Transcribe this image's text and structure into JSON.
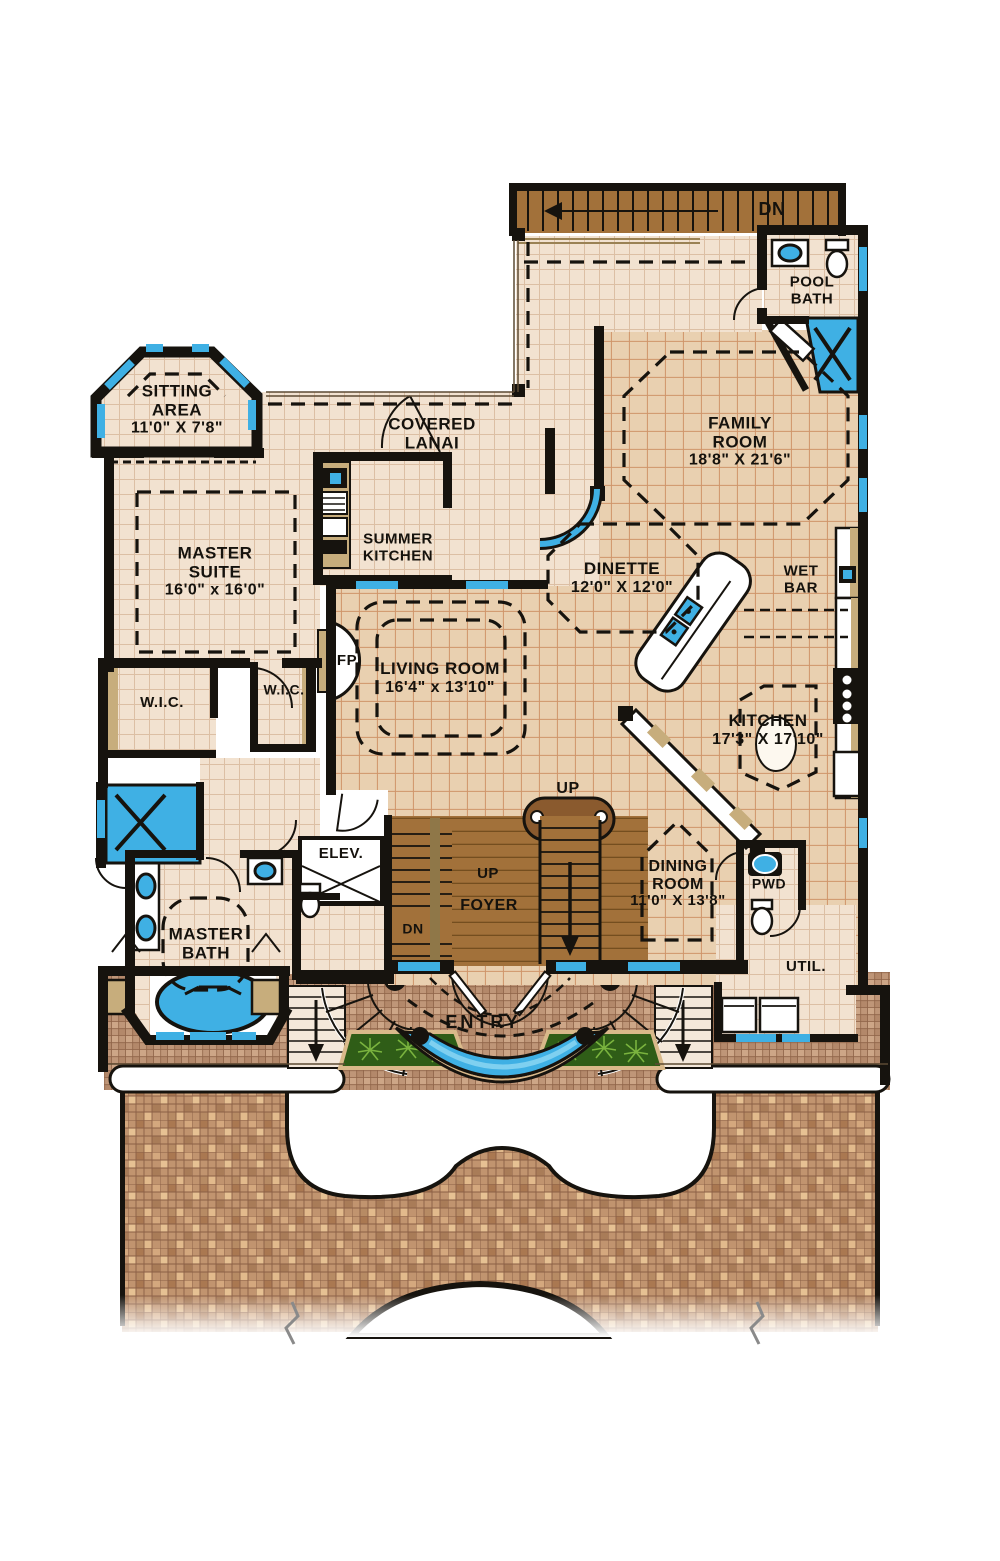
{
  "plan_title": "First Floor Plan",
  "colors": {
    "wall": "#16130e",
    "tile_light": "#f2e2d0",
    "tile_tan": "#e9d0b0",
    "wood": "#a2713a",
    "water_blue": "#3fb0e4",
    "counter_tan": "#c7ad7c",
    "brick_terrace": "#bf9678",
    "mosaic_drive": "#c1946f",
    "plant_green": "#2f5d17"
  },
  "rooms": {
    "sitting_area": {
      "name": "SITTING AREA",
      "dims": "11'0\" X 7'8\""
    },
    "master_suite": {
      "name": "MASTER SUITE",
      "dims": "16'0\" x 16'0\""
    },
    "covered_lanai": {
      "name": "COVERED LANAI"
    },
    "summer_kitchen": {
      "name": "SUMMER KITCHEN"
    },
    "family_room": {
      "name": "FAMILY ROOM",
      "dims": "18'8\" X 21'6\""
    },
    "pool_bath": {
      "name": "POOL BATH"
    },
    "dinette": {
      "name": "DINETTE",
      "dims": "12'0\" X 12'0\""
    },
    "wet_bar": {
      "name": "WET BAR"
    },
    "living_room": {
      "name": "LIVING ROOM",
      "dims": "16'4\" x 13'10\""
    },
    "kitchen": {
      "name": "KITCHEN",
      "dims": "17'3\" X 17'10\""
    },
    "wic_left": {
      "name": "W.I.C."
    },
    "wic_right": {
      "name": "W.I.C."
    },
    "fireplace": {
      "name": "FP"
    },
    "elevator": {
      "name": "ELEV."
    },
    "foyer": {
      "name": "FOYER"
    },
    "dining_room": {
      "name": "DINING ROOM",
      "dims": "11'0\" X 13'8\""
    },
    "powder": {
      "name": "PWD"
    },
    "utility": {
      "name": "UTIL."
    },
    "master_bath": {
      "name": "MASTER BATH"
    },
    "entry": {
      "name": "ENTRY"
    }
  },
  "stairs": {
    "top_down": "DN",
    "main_up": "UP",
    "foyer_up": "UP",
    "foyer_down": "DN"
  }
}
